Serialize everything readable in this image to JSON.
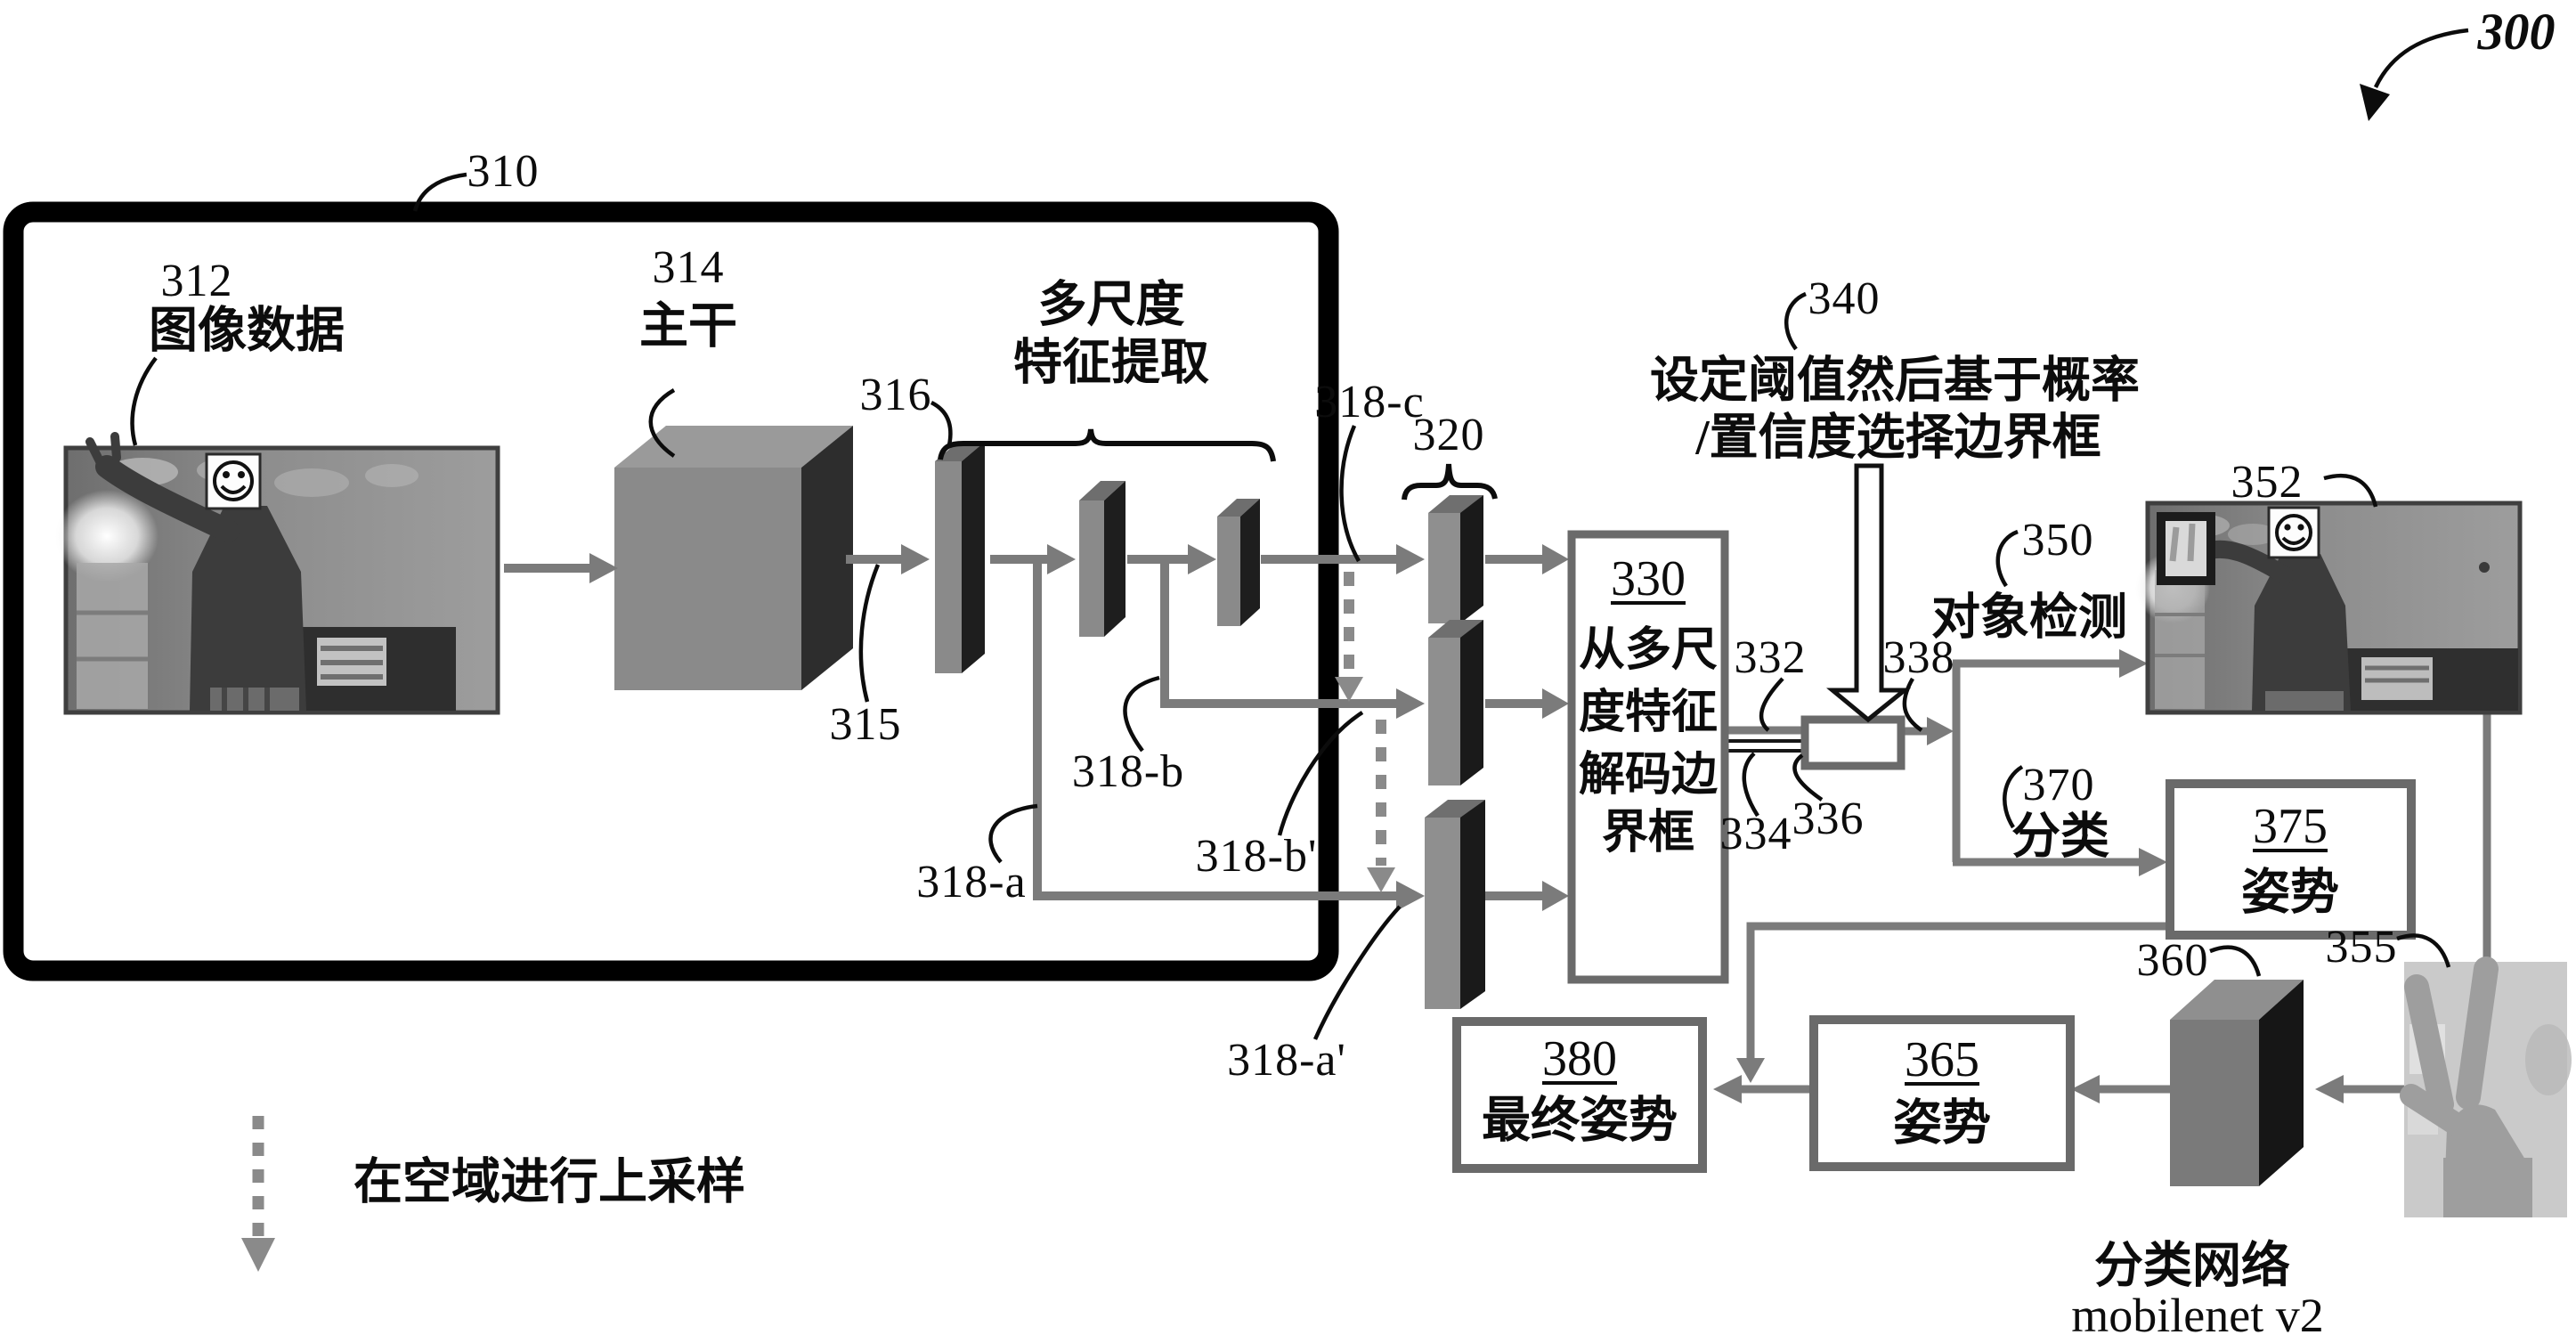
{
  "colors": {
    "arrow_gray": "#7b7b7b",
    "box_border_gray": "#6a6a6a",
    "frame_black": "#000000",
    "slab_gray": "#8f8f8f",
    "slab_dark": "#1a1a1a",
    "dashed_gray": "#8a8a8a"
  },
  "fig": {
    "ref": "300"
  },
  "pipeline": {
    "ref": "310"
  },
  "image_data": {
    "ref": "312",
    "caption": "图像数据"
  },
  "backbone": {
    "ref": "314",
    "label": "主干",
    "arrow_ref": "315"
  },
  "multiscale": {
    "ref": "316",
    "line1": "多尺度",
    "line2": "特征提取"
  },
  "features": {
    "a": "318-a",
    "b": "318-b",
    "c": "318-c",
    "b_up": "318-b'",
    "a_up": "318-a'"
  },
  "pyramid": {
    "ref": "320"
  },
  "decoder": {
    "ref": "330",
    "line1": "从多尺",
    "line2": "度特征",
    "line3": "解码边",
    "line4": "界框",
    "out1": "332",
    "out2": "334",
    "out3": "336",
    "out_arrow": "338"
  },
  "threshold": {
    "ref": "340",
    "line1": "设定阈值然后基于概率",
    "line2": "/置信度选择边界框"
  },
  "detection": {
    "ref": "350",
    "label": "对象检测",
    "image_ref": "352"
  },
  "classification": {
    "ref": "370",
    "label": "分类"
  },
  "pose_box": {
    "ref": "375",
    "label": "姿势"
  },
  "hand_crop": {
    "ref": "355"
  },
  "cls_network": {
    "ref": "360",
    "caption1": "分类网络",
    "caption2": "mobilenet v2"
  },
  "pose_box2": {
    "ref": "365",
    "label": "姿势"
  },
  "final_pose": {
    "ref": "380",
    "label": "最终姿势"
  },
  "legend": {
    "label": "在空域进行上采样"
  }
}
